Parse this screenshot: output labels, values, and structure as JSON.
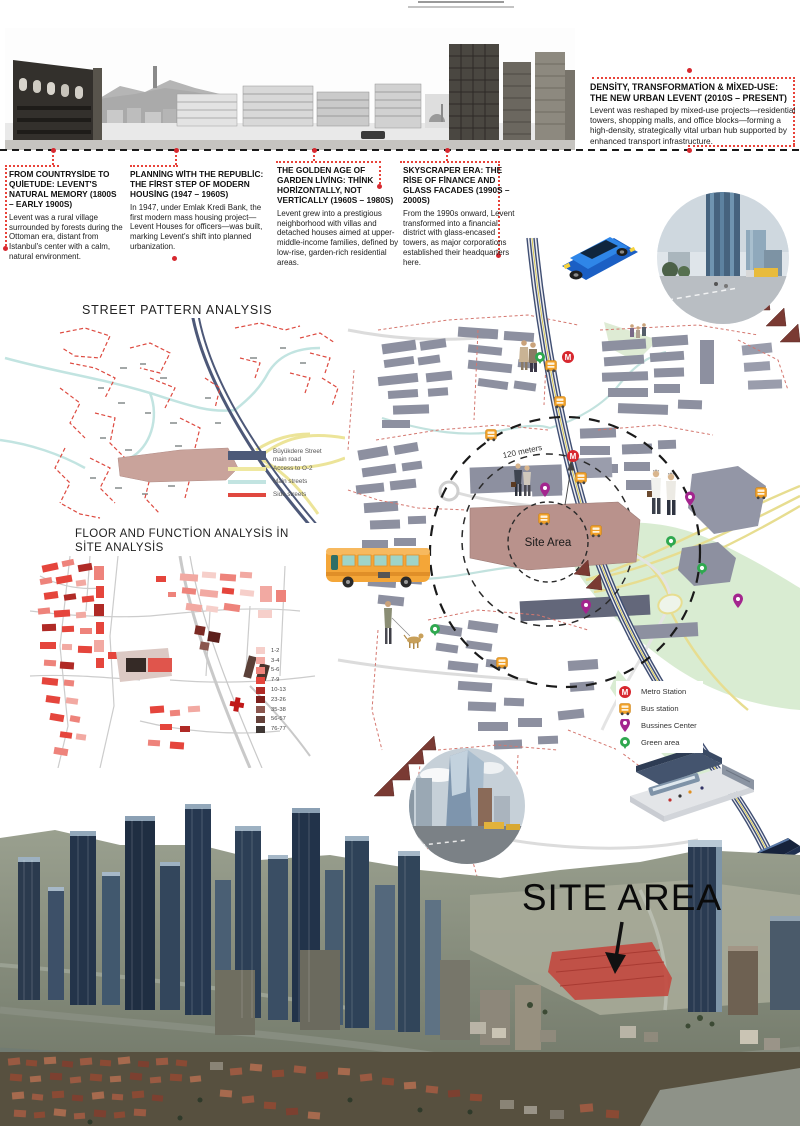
{
  "timeline": {
    "eras": [
      {
        "title": "FROM COUNTRYSİDE TO QUİETUDE: LEVENT'S NATURAL MEMORY (1800S – EARLY 1900S)",
        "body": "Levent was a rural village surrounded by forests during the Ottoman era, distant from Istanbul's center with a calm, natural environment."
      },
      {
        "title": "PLANNİNG WİTH THE REPUBLİC: THE FİRST STEP OF MODERN HOUSİNG (1947 – 1960S)",
        "body": "In 1947, under Emlak Kredi Bank, the first modern mass housing project—Levent Houses for officers—was built, marking Levent's shift into planned urbanization."
      },
      {
        "title": "THE GOLDEN AGE OF GARDEN LİVİNG: THİNK HORİZONTALLY, NOT VERTİCALLY (1960S – 1980S)",
        "body": "Levent grew into a prestigious neighborhood with villas and detached houses aimed at upper-middle-income families, defined by low-rise, garden-rich residential areas."
      },
      {
        "title": "SKYSCRAPER ERA: THE RİSE OF FİNANCE AND GLASS FACADES (1990S – 2000S)",
        "body": "From the 1990s onward, Levent transformed into a financial district with glass-encased towers, as major corporations established their headquarters here."
      },
      {
        "title": "DENSİTY, TRANSFORMATİON & MİXED-USE: THE NEW URBAN LEVENT (2010S – PRESENT)",
        "body": "Levent was reshaped by mixed-use projects—residential towers, shopping malls, and office blocks—forming a high-density, strategically vital urban hub supported by enhanced transport infrastructure."
      }
    ]
  },
  "street_pattern": {
    "title": "STREET PATTERN ANALYSIS",
    "legend": [
      {
        "label": "Büyükdere Street main road",
        "color": "#4d5a78"
      },
      {
        "label": "Access to O-2",
        "color": "#efe8a0"
      },
      {
        "label": "Main streets",
        "color": "#c2e4e1"
      },
      {
        "label": "Side streets",
        "color": "#e0483f"
      }
    ]
  },
  "floor_function": {
    "title_line1": "FLOOR AND FUNCTİON ANALYSİS İN",
    "title_line2": "SİTE ANALYSİS",
    "legend": [
      {
        "label": "1-2",
        "color": "#f6cfca"
      },
      {
        "label": "3-4",
        "color": "#f2a9a2"
      },
      {
        "label": "5-6",
        "color": "#ee837b"
      },
      {
        "label": "7-9",
        "color": "#e5453c"
      },
      {
        "label": "10-13",
        "color": "#b02a26"
      },
      {
        "label": "23-26",
        "color": "#7c1f1c"
      },
      {
        "label": "35-38",
        "color": "#8a564e"
      },
      {
        "label": "56-57",
        "color": "#64413a"
      },
      {
        "label": "76-77",
        "color": "#3f3734"
      }
    ]
  },
  "site_map": {
    "radius_label": "120 meters",
    "site_area_label": "Site Area",
    "metro_letter": "M",
    "legend": [
      {
        "icon": "metro-icon",
        "label": "Metro Station"
      },
      {
        "icon": "bus-icon",
        "label": "Bus station"
      },
      {
        "icon": "business-pin-icon",
        "label": "Bussines Center"
      },
      {
        "icon": "green-area-icon",
        "label": "Green area"
      }
    ]
  },
  "render": {
    "site_area_label": "SITE AREA"
  },
  "colors": {
    "accent_red": "#d7282f",
    "connector_red": "#e8433a",
    "navy_road": "#4d5a78",
    "access_yellow": "#efe8a0",
    "main_street_cyan": "#c2e4e1",
    "side_street_red": "#e0483f",
    "site_mauve": "#bc958f",
    "green_area": "#d9ecd2",
    "bus_orange": "#f0a028",
    "business_purple": "#a3258e",
    "green_pin": "#2fa84f",
    "site_highlight": "#c24a40"
  }
}
